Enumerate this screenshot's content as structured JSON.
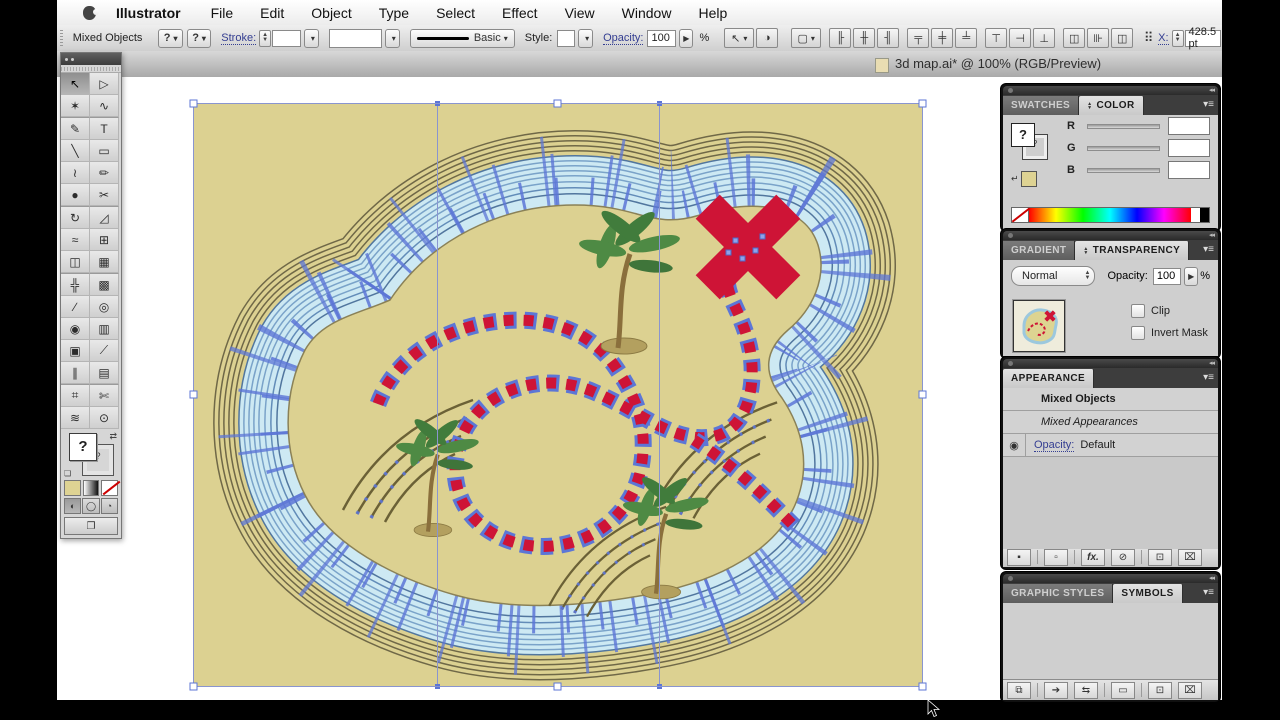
{
  "menu_bar": {
    "items": [
      "Illustrator",
      "File",
      "Edit",
      "Object",
      "Type",
      "Select",
      "Effect",
      "View",
      "Window",
      "Help"
    ]
  },
  "control_bar": {
    "selection_label": "Mixed Objects",
    "q1": "?",
    "q2": "?",
    "stroke_label": "Stroke:",
    "brush_name": "Basic",
    "style_label": "Style:",
    "opacity_label": "Opacity:",
    "opacity_value": "100",
    "percent": "%",
    "x_label": "X:",
    "x_value": "428.5 pt"
  },
  "title_bar": {
    "title": "3d map.ai* @ 100% (RGB/Preview)"
  },
  "panels": {
    "color": {
      "tab_swatches": "SWATCHES",
      "tab_color": "COLOR",
      "r": "R",
      "g": "G",
      "b": "B",
      "fill_unknown": "?",
      "stroke_unknown": "?"
    },
    "transparency": {
      "tab_gradient": "GRADIENT",
      "tab_transparency": "TRANSPARENCY",
      "blend_mode": "Normal",
      "opacity_label": "Opacity:",
      "opacity_value": "100",
      "percent": "%",
      "clip_label": "Clip",
      "invert_label": "Invert Mask"
    },
    "appearance": {
      "title": "APPEARANCE",
      "row1": "Mixed Objects",
      "row2": "Mixed Appearances",
      "row3_label": "Opacity:",
      "row3_value": "Default",
      "fx_label": "fx."
    },
    "symbols": {
      "tab_styles": "GRAPHIC STYLES",
      "tab_symbols": "SYMBOLS"
    }
  },
  "toolbar": {
    "fill_unknown": "?",
    "stroke_unknown": "?",
    "tools": [
      {
        "glyph": "↖"
      },
      {
        "glyph": "▷"
      },
      {
        "glyph": "✶"
      },
      {
        "glyph": "∿"
      },
      {
        "glyph": "✎"
      },
      {
        "glyph": "T"
      },
      {
        "glyph": "╲"
      },
      {
        "glyph": "▭"
      },
      {
        "glyph": "≀"
      },
      {
        "glyph": "✏"
      },
      {
        "glyph": "●"
      },
      {
        "glyph": "✂"
      },
      {
        "glyph": "↻"
      },
      {
        "glyph": "◿"
      },
      {
        "glyph": "≈"
      },
      {
        "glyph": "⊞"
      },
      {
        "glyph": "◫"
      },
      {
        "glyph": "▦"
      },
      {
        "glyph": "╬"
      },
      {
        "glyph": "▩"
      },
      {
        "glyph": "∕"
      },
      {
        "glyph": "◎"
      },
      {
        "glyph": "◉"
      },
      {
        "glyph": "▥"
      },
      {
        "glyph": "▣"
      },
      {
        "glyph": "⟋"
      },
      {
        "glyph": "∥"
      },
      {
        "glyph": "▤"
      },
      {
        "glyph": "⌗"
      },
      {
        "glyph": "✄"
      },
      {
        "glyph": "≋"
      },
      {
        "glyph": "⊙"
      }
    ]
  },
  "icons": {
    "dropdown": "▾",
    "flyout": "▶",
    "up": "▲",
    "down": "▼",
    "panel_menu": "▾≡",
    "collapse": "◂◂",
    "dbl_up": "▲",
    "dbl_down": "▼",
    "eye": "◉",
    "new_stroke": "▪",
    "new_fill": "▫",
    "clear": "⊘",
    "new_item": "⊡",
    "trash": "⌧",
    "libraries": "⧉",
    "place": "➔",
    "break_link": "⇆",
    "frame": "▭",
    "grid9": "⠿",
    "sel_similar": "↖",
    "recolor": "◑",
    "align_box": "▢",
    "al1": "╟",
    "al2": "╫",
    "al3": "╢",
    "al4": "╤",
    "al5": "╪",
    "al6": "╧",
    "d1": "⊤",
    "d2": "⊣",
    "d3": "⊥",
    "d4": "◫",
    "d5": "⊪",
    "d6": "◫"
  },
  "colors": {
    "selection_blue": "#5c76d6",
    "map_red": "#ce1436",
    "island_tan": "#dcd191",
    "water": "#cde9f3",
    "palm_green": "#4e8a44",
    "ring_olive": "#6f6847"
  }
}
